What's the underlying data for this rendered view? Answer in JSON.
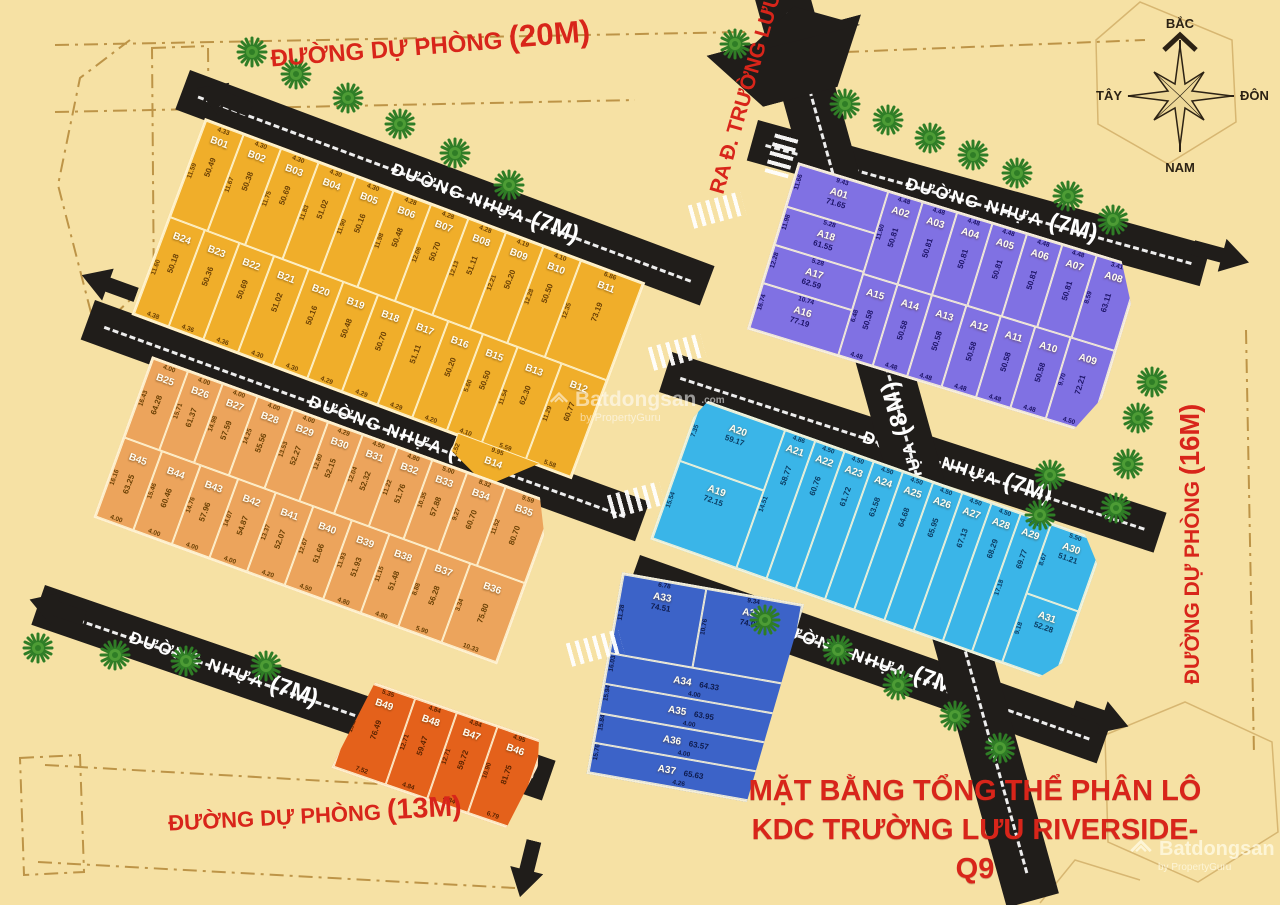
{
  "title": {
    "line1": "MẶT BẰNG TỔNG THỂ PHÂN LÔ",
    "line2": "KDC TRƯỜNG LƯU RIVERSIDE-Q9"
  },
  "roads": {
    "asphalt_name": "ĐƯỜNG NHỰA",
    "asphalt_7m": "(7M)",
    "asphalt_8m": "(8M)",
    "reserve_name": "ĐƯỜNG DỰ PHÒNG",
    "reserve_20m": "(20M)",
    "reserve_16m": "(16M)",
    "reserve_13m": "(13M)",
    "exit_label": "RA Đ. TRƯỜNG LƯU"
  },
  "compass": {
    "north": "BẮC",
    "south": "NAM",
    "east": "ĐÔNG",
    "west": "TÂY"
  },
  "watermark": {
    "brand": "Batdongsan",
    "domain": ".com",
    "domain2": "com.vn",
    "tagline": "by PropertyGuru"
  },
  "blocks": {
    "yellow": {
      "rows": [
        [
          {
            "id": "B01",
            "w": "4.33",
            "d": "11.59",
            "a": "50.49"
          },
          {
            "id": "B02",
            "w": "4.30",
            "d": "11.67",
            "a": "50.38"
          },
          {
            "id": "B03",
            "w": "4.30",
            "d": "11.75",
            "a": "50.69"
          },
          {
            "id": "B04",
            "w": "4.30",
            "d": "11.83",
            "a": "51.02"
          },
          {
            "id": "B05",
            "w": "4.30",
            "d": "11.90",
            "a": "50.16"
          },
          {
            "id": "B06",
            "w": "4.28",
            "d": "11.98",
            "a": "50.48"
          },
          {
            "id": "B07",
            "w": "4.28",
            "d": "12.06",
            "a": "50.70"
          },
          {
            "id": "B08",
            "w": "4.28",
            "d": "12.13",
            "a": "51.11"
          },
          {
            "id": "B09",
            "w": "4.19",
            "d": "12.21",
            "a": "50.20"
          },
          {
            "id": "B10",
            "w": "4.10",
            "d": "12.28",
            "a": "50.50"
          },
          {
            "id": "B11",
            "w": "6.86",
            "d": "12.35",
            "a": "73.19",
            "f": "1.7"
          }
        ],
        [
          {
            "id": "B24",
            "w": "4.38",
            "d": "11.60",
            "a": "50.18"
          },
          {
            "id": "B23",
            "w": "4.36",
            "a": "50.36"
          },
          {
            "id": "B22",
            "w": "4.36",
            "a": "50.69"
          },
          {
            "id": "B21",
            "w": "4.30",
            "a": "51.02"
          },
          {
            "id": "B20",
            "w": "4.30",
            "a": "50.16"
          },
          {
            "id": "B19",
            "w": "4.29",
            "a": "50.48"
          },
          {
            "id": "B18",
            "w": "4.29",
            "a": "50.70"
          },
          {
            "id": "B17",
            "w": "4.29",
            "a": "51.11"
          },
          {
            "id": "B16",
            "w": "4.20",
            "a": "50.20"
          },
          {
            "id": "B15",
            "w": "4.10",
            "d": "5.60",
            "a": "50.50"
          },
          {
            "id": "B13",
            "w": "5.59",
            "d": "11.54",
            "a": "62.30",
            "f": "1.3"
          },
          {
            "id": "B12",
            "w": "5.58",
            "d": "11.29",
            "a": "60.77",
            "f": "1.3"
          }
        ]
      ],
      "tip": [
        {
          "id": "B14",
          "w": "9.95",
          "d": "2.52",
          "a": "79.33"
        }
      ]
    },
    "purple": {
      "left": [
        {
          "id": "A01",
          "w": "9.43",
          "d": "11.66",
          "a": "71.65",
          "f": "1.1"
        },
        {
          "id": "A18",
          "w": "5.28",
          "d": "11.98",
          "a": "61.55"
        },
        {
          "id": "A17",
          "w": "5.28",
          "d": "12.28",
          "a": "62.59"
        },
        {
          "id": "A16",
          "w": "10.74",
          "d": "16.74",
          "a": "77.19",
          "f": "1.2"
        }
      ],
      "rows": [
        [
          {
            "id": "A02",
            "w": "4.48",
            "d": "11.60",
            "a": "50.81"
          },
          {
            "id": "A03",
            "w": "4.48",
            "a": "50.81"
          },
          {
            "id": "A04",
            "w": "4.48",
            "a": "50.81"
          },
          {
            "id": "A05",
            "w": "4.48",
            "a": "50.81"
          },
          {
            "id": "A06",
            "w": "4.48",
            "a": "50.81"
          },
          {
            "id": "A07",
            "w": "4.48",
            "a": "50.81"
          },
          {
            "id": "A08",
            "w": "3.41",
            "d": "8.59",
            "a": "63.11",
            "f": "1.25"
          }
        ],
        [
          {
            "id": "A15",
            "w": "4.48",
            "d": "6.48",
            "a": "50.58"
          },
          {
            "id": "A14",
            "w": "4.48",
            "a": "50.58"
          },
          {
            "id": "A13",
            "w": "4.48",
            "a": "50.58"
          },
          {
            "id": "A12",
            "w": "4.48",
            "a": "50.58"
          },
          {
            "id": "A11",
            "w": "4.48",
            "a": "50.58"
          },
          {
            "id": "A10",
            "w": "4.48",
            "a": "50.58"
          },
          {
            "id": "A09",
            "w": "4.50",
            "d": "9.70",
            "a": "72.21",
            "f": "1.3"
          }
        ]
      ]
    },
    "cyan": {
      "left": [
        {
          "id": "A20",
          "d": "7.35",
          "a": "59.17",
          "f": "0.9"
        },
        {
          "id": "A19",
          "d": "15.54",
          "a": "72.15",
          "f": "1.15"
        }
      ],
      "mid": [
        {
          "id": "A21",
          "w": "4.86",
          "d": "14.51",
          "a": "58.77"
        },
        {
          "id": "A22",
          "w": "4.50",
          "a": "60.76"
        },
        {
          "id": "A23",
          "w": "4.50",
          "a": "61.72"
        },
        {
          "id": "A24",
          "w": "4.50",
          "a": "63.58"
        },
        {
          "id": "A25",
          "w": "4.50",
          "a": "64.68"
        },
        {
          "id": "A26",
          "w": "4.50",
          "a": "65.95"
        },
        {
          "id": "A27",
          "w": "4.50",
          "a": "67.13"
        },
        {
          "id": "A28",
          "w": "4.50",
          "a": "68.29"
        },
        {
          "id": "A29",
          "w": "4.50",
          "d": "17.18",
          "a": "69.77"
        }
      ],
      "right": [
        {
          "id": "A30",
          "w": "5.50",
          "d": "8.67",
          "a": "51.21"
        },
        {
          "id": "A31",
          "d": "9.18",
          "a": "52.28"
        }
      ]
    },
    "blue": {
      "top": [
        {
          "id": "A33",
          "w": "6.78",
          "d": "11.28",
          "a": "74.51"
        },
        {
          "id": "A32",
          "w": "9.34",
          "d": "10.76",
          "a": "74.05",
          "f": "1.15"
        }
      ],
      "strips": [
        {
          "id": "A34",
          "w": "4.00",
          "d": "16.03",
          "a": "64.33"
        },
        {
          "id": "A35",
          "w": "4.00",
          "d": "15.94",
          "a": "63.95"
        },
        {
          "id": "A36",
          "w": "4.00",
          "d": "15.84",
          "a": "63.57"
        },
        {
          "id": "A37",
          "w": "4.26",
          "d": "15.76",
          "a": "65.63"
        }
      ]
    },
    "orange": {
      "rows": [
        [
          {
            "id": "B25",
            "w": "4.00",
            "d": "16.43",
            "a": "64.28"
          },
          {
            "id": "B26",
            "w": "4.00",
            "d": "15.71",
            "a": "61.37"
          },
          {
            "id": "B27",
            "w": "4.00",
            "d": "14.98",
            "a": "57.59"
          },
          {
            "id": "B28",
            "w": "4.00",
            "d": "14.25",
            "a": "55.56"
          },
          {
            "id": "B29",
            "w": "4.00",
            "d": "13.53",
            "a": "52.27"
          },
          {
            "id": "B30",
            "w": "4.29",
            "d": "12.80",
            "a": "52.15"
          },
          {
            "id": "B31",
            "w": "4.50",
            "d": "12.04",
            "a": "52.32"
          },
          {
            "id": "B32",
            "w": "4.80",
            "d": "11.22",
            "a": "51.76"
          },
          {
            "id": "B33",
            "w": "5.00",
            "d": "10.35",
            "a": "57.88"
          },
          {
            "id": "B34",
            "w": "8.32",
            "d": "9.27",
            "a": "60.70",
            "f": "1.1"
          },
          {
            "id": "B35",
            "w": "9.59",
            "d": "11.52",
            "a": "80.70",
            "f": "1.4"
          }
        ],
        [
          {
            "id": "B45",
            "w": "4.00",
            "d": "16.16",
            "a": "63.25"
          },
          {
            "id": "B44",
            "w": "4.00",
            "d": "15.46",
            "a": "60.46"
          },
          {
            "id": "B43",
            "w": "4.00",
            "d": "14.76",
            "a": "57.96"
          },
          {
            "id": "B42",
            "w": "4.00",
            "d": "14.07",
            "a": "54.87"
          },
          {
            "id": "B41",
            "w": "4.20",
            "d": "13.37",
            "a": "52.07"
          },
          {
            "id": "B40",
            "w": "4.50",
            "d": "12.67",
            "a": "51.66"
          },
          {
            "id": "B39",
            "w": "4.80",
            "d": "11.93",
            "a": "51.93"
          },
          {
            "id": "B38",
            "w": "4.80",
            "d": "11.15",
            "a": "51.48"
          },
          {
            "id": "B37",
            "w": "5.90",
            "d": "8.88",
            "a": "56.28",
            "f": "1.15"
          },
          {
            "id": "B36",
            "w": "10.33",
            "d": "3.34",
            "a": "75.80",
            "f": "1.45"
          }
        ]
      ]
    },
    "dorange": {
      "row": [
        {
          "id": "B49",
          "w": "5.35",
          "d": "13.28",
          "a": "76.49",
          "b": "7.52",
          "f": "1.3"
        },
        {
          "id": "B48",
          "w": "4.84",
          "d": "12.71",
          "a": "59.47",
          "b": "4.84"
        },
        {
          "id": "B47",
          "w": "4.84",
          "d": "12.71",
          "a": "59.72",
          "b": "4.84"
        },
        {
          "id": "B46",
          "w": "4.95",
          "d": "10.90",
          "a": "81.75",
          "b": "6.79",
          "f": "1.15"
        }
      ]
    }
  }
}
